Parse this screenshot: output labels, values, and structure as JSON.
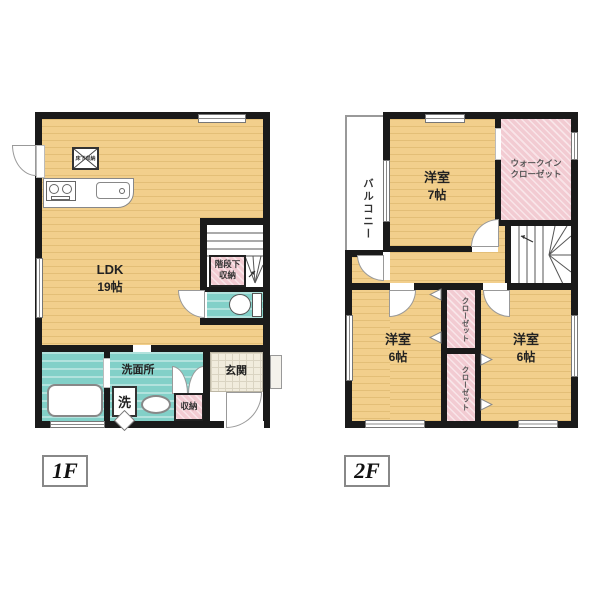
{
  "floor1": {
    "tag": "1F",
    "ldk_label": "LDK",
    "ldk_size": "19帖",
    "floor_hatch": "床下収納",
    "stair_storage_l1": "階段下",
    "stair_storage_l2": "収納",
    "washroom": "洗面所",
    "washer": "洗",
    "storage": "収納",
    "entrance": "玄関"
  },
  "floor2": {
    "tag": "2F",
    "balcony": "バルコニー",
    "room7_label": "洋室",
    "room7_size": "7帖",
    "wic_l1": "ウォークイン",
    "wic_l2": "クローゼット",
    "closet_top": "クローゼット",
    "closet_bottom": "クローゼット",
    "room6_left_label": "洋室",
    "room6_left_size": "6帖",
    "room6_right_label": "洋室",
    "room6_right_size": "6帖"
  },
  "colors": {
    "wall": "#1a1a1a",
    "wood_floor": "#f2cf8c",
    "wet_area": "#82d0c8",
    "closet_pink": "#f2cbd2",
    "entrance_tile": "#f1ecdd"
  }
}
